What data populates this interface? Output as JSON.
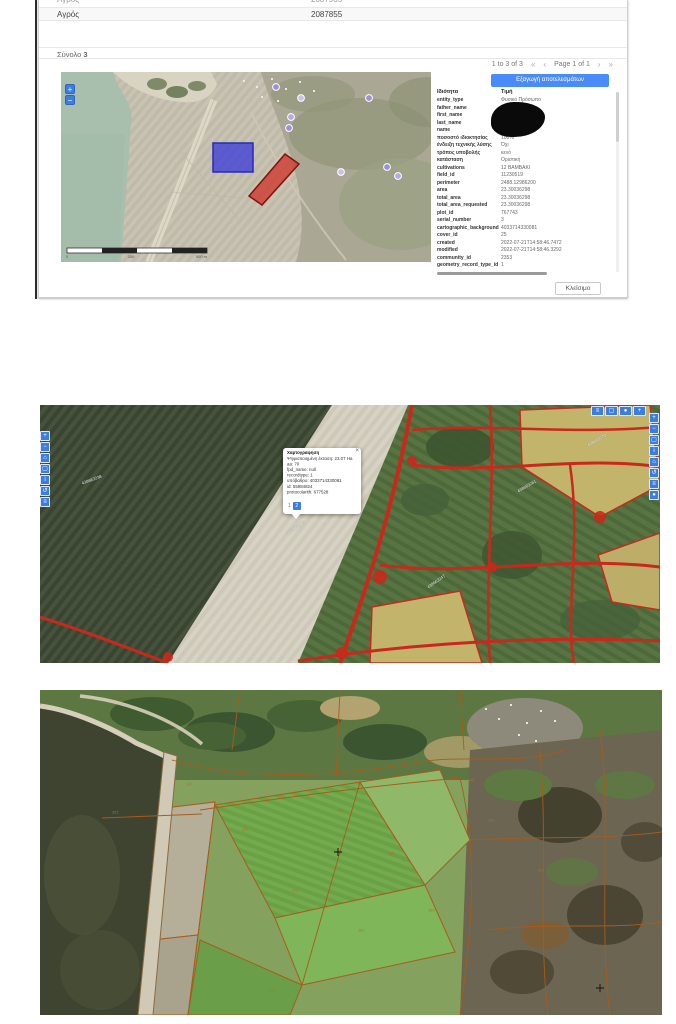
{
  "colors": {
    "accent_blue": "#4a8cf7",
    "toolbar_blue": "#3c7de2",
    "parcel_blue": "#3e3ed8",
    "parcel_red": "#cf3a30",
    "overlay_red": "#c8291c",
    "cadastral_orange": "#a85c1c"
  },
  "window": {
    "grid": {
      "clipped_row": {
        "col1": "Αγρός",
        "col2": "2087935"
      },
      "row": {
        "col1": "Αγρός",
        "col2": "2087855"
      },
      "total_label": "Σύνολο",
      "total_value": "3",
      "range_label": "1 to 3 of 3",
      "page_label": "Page 1 of 1",
      "pager_icons": {
        "first": "«",
        "prev": "‹",
        "next": "›",
        "last": "»"
      }
    },
    "map": {
      "zoom_in": "+",
      "zoom_out": "−",
      "scale_ticks": {
        "t0": "0",
        "t1": "250",
        "t2": "500 m"
      }
    },
    "panel": {
      "export_button": "Εξαγωγή αποτελεσμάτων",
      "col_key": "Ιδιότητα",
      "col_val": "Τιμή",
      "rows": [
        {
          "k": "entity_type",
          "v": "Φυσικό Πρόσωπο"
        },
        {
          "k": "father_name",
          "v": "ΑΝΔΡΕΑΣ"
        },
        {
          "k": "first_name",
          "v": ""
        },
        {
          "k": "last_name",
          "v": ""
        },
        {
          "k": "name",
          "v": "ΓΑΒΡΙΗΛ"
        },
        {
          "k": "ποσοστό ιδιοκτησίας",
          "v": "100%"
        },
        {
          "k": "ένδειξη τεχνικής λύσης",
          "v": "Όχι"
        },
        {
          "k": "τρόπος υποβολής",
          "v": "κενό"
        },
        {
          "k": "κατάσταση",
          "v": "Οριστική"
        },
        {
          "k": "cultivations",
          "v": "12 ΒΑΜΒΑΚΙ"
        },
        {
          "k": "field_id",
          "v": "11230519"
        },
        {
          "k": "perimeter",
          "v": "2488.12986200"
        },
        {
          "k": "area",
          "v": "23.30036298"
        },
        {
          "k": "total_area",
          "v": "23.30036298"
        },
        {
          "k": "total_area_requested",
          "v": "23.30036298"
        },
        {
          "k": "plot_id",
          "v": "767743"
        },
        {
          "k": "serial_number",
          "v": "3"
        },
        {
          "k": "cartographic_background",
          "v": "4033714330081"
        },
        {
          "k": "cover_id",
          "v": "25"
        },
        {
          "k": "created",
          "v": "2022-07-21T14:58:46.7472"
        },
        {
          "k": "modified",
          "v": "2022-07-21T14:58:46.3292"
        },
        {
          "k": "community_id",
          "v": "2353"
        },
        {
          "k": "geometry_record_type_id",
          "v": "1"
        }
      ]
    },
    "close_button": "Κλείσιμο"
  },
  "map2": {
    "left_toolbar": [
      "+",
      "−",
      "⌂",
      "▢",
      "i",
      "↺",
      "≡"
    ],
    "right_toolbar": [
      "+",
      "−",
      "▢",
      "i",
      "⌂",
      "↺",
      "≡",
      "●"
    ],
    "top_toolbar": [
      "≡",
      "▢",
      "●",
      "+"
    ],
    "popup": {
      "title": "Χαρτογράφηση",
      "lines": [
        "Ψηφιοποιημένη έκταση: 23.07 Ha",
        "aa: 70",
        "fpd_name: null",
        "recordtype: 1",
        "υπόβαθρο: 4033714330081",
        "id: 55984824",
        "protocolarith: 677528"
      ],
      "close_icon": "×",
      "pager": [
        "1",
        "2"
      ]
    },
    "labels": [
      "438663238",
      "438663252",
      "438663247",
      "438663261",
      "438663270"
    ]
  },
  "map3": {
    "labels": [
      "247",
      "251",
      "263",
      "268",
      "270",
      "281",
      "285",
      "292",
      "301",
      "308",
      "314",
      "322"
    ]
  }
}
